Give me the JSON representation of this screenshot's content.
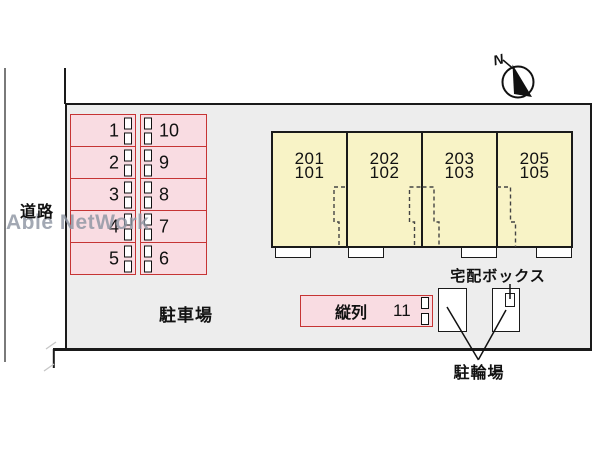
{
  "watermark": "Able NetWork",
  "compass": {
    "north_label": "N"
  },
  "site": {
    "road_label": "道路",
    "parking_area_label": "駐車場",
    "delivery_box_label": "宅配ボックス",
    "bicycle_parking_label": "駐輪場"
  },
  "parking_grid": {
    "left_column": [
      "1",
      "2",
      "3",
      "4",
      "5"
    ],
    "right_column": [
      "10",
      "9",
      "8",
      "7",
      "6"
    ]
  },
  "tandem_stall": {
    "label": "縦列",
    "number": "11"
  },
  "building": {
    "units": [
      {
        "upper": "201",
        "lower": "101"
      },
      {
        "upper": "202",
        "lower": "102"
      },
      {
        "upper": "203",
        "lower": "103"
      },
      {
        "upper": "205",
        "lower": "105"
      }
    ]
  },
  "colors": {
    "stall_fill": "#f9dce2",
    "stall_border": "#c63434",
    "building_fill": "#f8f3c6",
    "site_fill": "#ededed",
    "line": "#1a1a1a",
    "watermark": "#8e96a3"
  }
}
